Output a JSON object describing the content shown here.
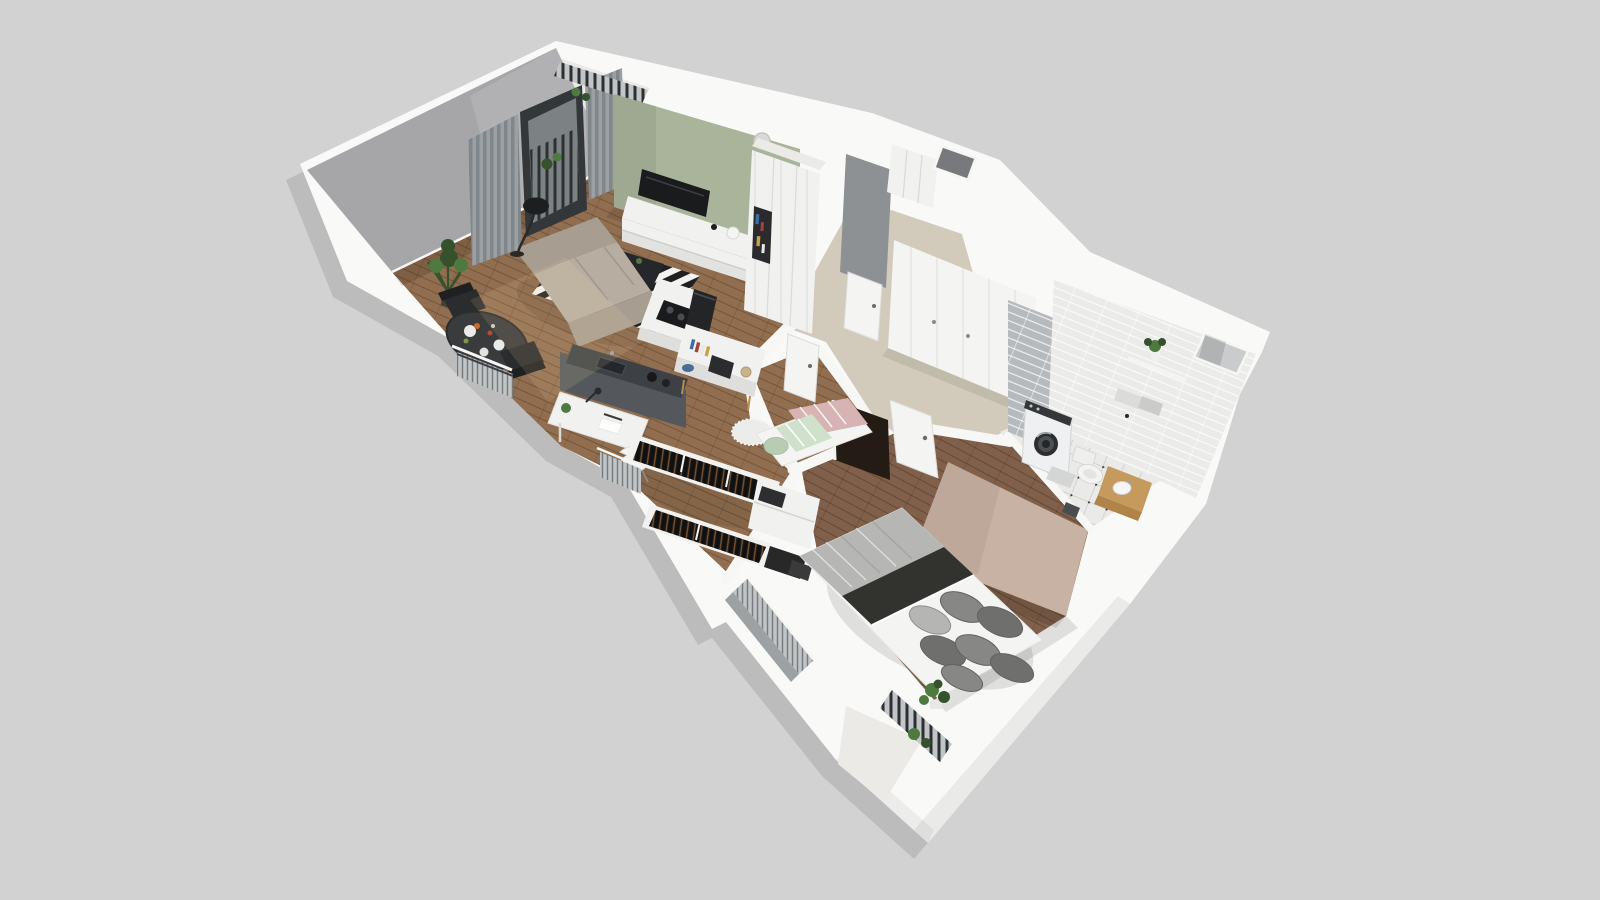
{
  "canvas": {
    "width": 1600,
    "height": 900
  },
  "scene": {
    "type": "isometric-3d-apartment-floorplan-render",
    "rooms": [
      "living-room",
      "dining-area",
      "kitchenette",
      "study-nook",
      "walk-in-closet",
      "small-bedroom",
      "hallway",
      "entry",
      "bathroom",
      "bedroom",
      "balcony-top",
      "balcony-bottom"
    ]
  },
  "palette": {
    "bg": "#d2d2d2",
    "wallTop": "#f9f9f7",
    "wallSide": "#eceae7",
    "wallInnerGray": "#a6a6a8",
    "wallInnerDark": "#8e9194",
    "greenWall": "#a9b49b",
    "darkWall": "#54585c",
    "counterDark": "#3d4145",
    "beigeWall": "#c8b2a3",
    "hallFloor": "#d2cbbb",
    "woodLiving": "#916e4f",
    "woodBedroom": "#80604a",
    "tileFloor": "#eaeae8",
    "tileWall": "#ebebe9",
    "tileWallGray": "#b7babc",
    "furnWhite": "#f1f1ef",
    "furnShade": "#dededc",
    "doorWhite": "#f4f4f2",
    "tvBlack": "#1a1b1d",
    "sofa": "#b7ada0",
    "sofaDark": "#a79d90",
    "rugWhite": "#f2f2f0",
    "rugBlack": "#202020",
    "curtain": "#9aa0a4",
    "glass": "#7c8284",
    "frameDark": "#33373a",
    "metal": "#c2c5c7",
    "bedWhite": "#f4f4f2",
    "duvet": "#b6b6b4",
    "throw": "#32322e",
    "pillow": "#878785",
    "pillowDark": "#6f6f6d",
    "pillowLight": "#b5b5b3",
    "pink": "#d8b3b3",
    "mint": "#b7ccb2",
    "mintLight": "#cfe0cb",
    "clothesDark": "#161616",
    "plant": "#4e7a3f",
    "plantDark": "#35522c",
    "vanity": "#c69a5c",
    "vanityDark": "#b08349",
    "tableDark": "#3a3b3d",
    "chairBlack": "#2b2c2e",
    "applianceWhite": "#eef0f1",
    "openingDark": "#241c14",
    "bookBlue": "#3a6ea5",
    "bookRed": "#a54040",
    "bookTan": "#c8a24a"
  }
}
